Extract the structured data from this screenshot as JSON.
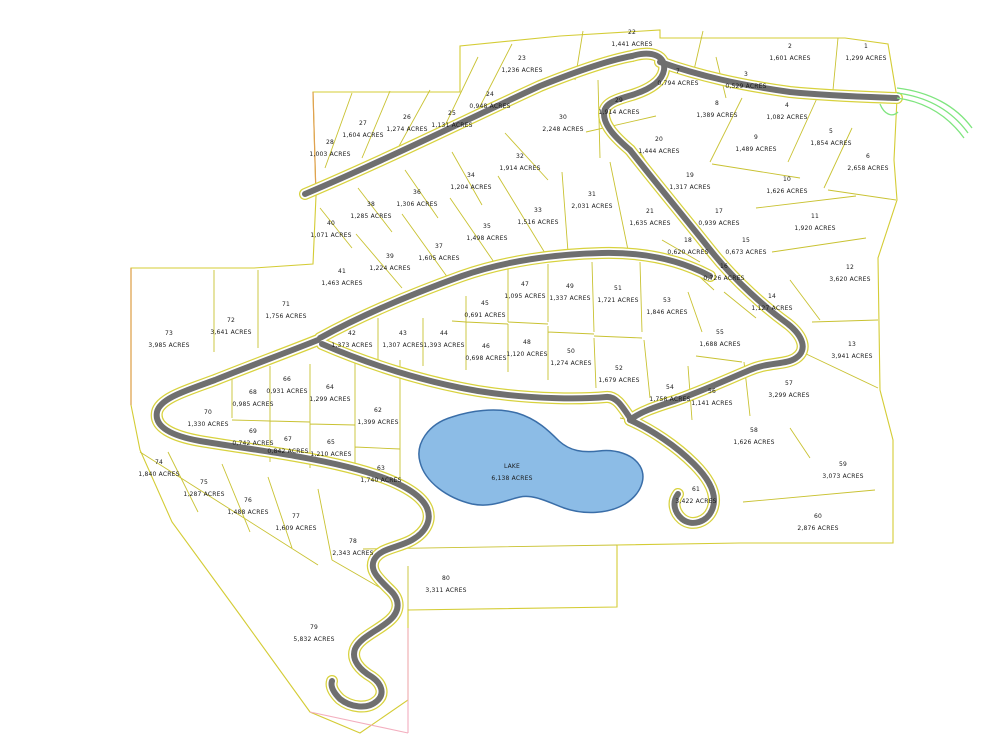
{
  "map": {
    "type": "subdivision-plat-map",
    "units_suffix": "ACRES",
    "colors": {
      "lot_line": "#c9c232",
      "boundary": "#d4cc35",
      "road_core": "#6f6f6f",
      "road_edge": "#d8d23e",
      "lake_fill": "#8cbce6",
      "lake_outline": "#3a6ea8",
      "creek": "#7fe57f",
      "west_boundary_orange": "#e0a050",
      "south_boundary_pink": "#f3aebe",
      "text": "#1a1a1a"
    }
  },
  "lake": {
    "label": "LAKE",
    "acres": "6,138 ACRES",
    "x": 512,
    "y": 472
  },
  "lots": [
    {
      "n": "1",
      "a": "1,299 ACRES",
      "x": 866,
      "y": 52
    },
    {
      "n": "2",
      "a": "1,601 ACRES",
      "x": 790,
      "y": 52
    },
    {
      "n": "3",
      "a": "0,529 ACRES",
      "x": 746,
      "y": 80
    },
    {
      "n": "4",
      "a": "1,082 ACRES",
      "x": 787,
      "y": 111
    },
    {
      "n": "5",
      "a": "1,854 ACRES",
      "x": 831,
      "y": 137
    },
    {
      "n": "6",
      "a": "2,658 ACRES",
      "x": 868,
      "y": 162
    },
    {
      "n": "7",
      "a": "0,794 ACRES",
      "x": 678,
      "y": 77
    },
    {
      "n": "8",
      "a": "1,389 ACRES",
      "x": 717,
      "y": 109
    },
    {
      "n": "9",
      "a": "1,489 ACRES",
      "x": 756,
      "y": 143
    },
    {
      "n": "10",
      "a": "1,626 ACRES",
      "x": 787,
      "y": 185
    },
    {
      "n": "11",
      "a": "1,920 ACRES",
      "x": 815,
      "y": 222
    },
    {
      "n": "12",
      "a": "3,620 ACRES",
      "x": 850,
      "y": 273
    },
    {
      "n": "13",
      "a": "3,941 ACRES",
      "x": 852,
      "y": 350
    },
    {
      "n": "14",
      "a": "1,127 ACRES",
      "x": 772,
      "y": 302
    },
    {
      "n": "15",
      "a": "0,673 ACRES",
      "x": 746,
      "y": 246
    },
    {
      "n": "16",
      "a": "0,726 ACRES",
      "x": 724,
      "y": 272
    },
    {
      "n": "17",
      "a": "0,939 ACRES",
      "x": 719,
      "y": 217
    },
    {
      "n": "18",
      "a": "0,620 ACRES",
      "x": 688,
      "y": 246
    },
    {
      "n": "19",
      "a": "1,317 ACRES",
      "x": 690,
      "y": 181
    },
    {
      "n": "20",
      "a": "1,444 ACRES",
      "x": 659,
      "y": 145
    },
    {
      "n": "21",
      "a": "1,635 ACRES",
      "x": 650,
      "y": 217
    },
    {
      "n": "22",
      "a": "1,441 ACRES",
      "x": 632,
      "y": 38
    },
    {
      "n": "23",
      "a": "1,236 ACRES",
      "x": 522,
      "y": 64
    },
    {
      "n": "24",
      "a": "0,948 ACRES",
      "x": 490,
      "y": 100
    },
    {
      "n": "25",
      "a": "1,131 ACRES",
      "x": 452,
      "y": 119
    },
    {
      "n": "26",
      "a": "1,274 ACRES",
      "x": 407,
      "y": 123
    },
    {
      "n": "27",
      "a": "1,604 ACRES",
      "x": 363,
      "y": 129
    },
    {
      "n": "28",
      "a": "1,003 ACRES",
      "x": 330,
      "y": 148
    },
    {
      "n": "29",
      "a": "1,914 ACRES",
      "x": 619,
      "y": 106
    },
    {
      "n": "30",
      "a": "2,248 ACRES",
      "x": 563,
      "y": 123
    },
    {
      "n": "31",
      "a": "2,031 ACRES",
      "x": 592,
      "y": 200
    },
    {
      "n": "32",
      "a": "1,914 ACRES",
      "x": 520,
      "y": 162
    },
    {
      "n": "33",
      "a": "1,516 ACRES",
      "x": 538,
      "y": 216
    },
    {
      "n": "34",
      "a": "1,204 ACRES",
      "x": 471,
      "y": 181
    },
    {
      "n": "35",
      "a": "1,498 ACRES",
      "x": 487,
      "y": 232
    },
    {
      "n": "36",
      "a": "1,306 ACRES",
      "x": 417,
      "y": 198
    },
    {
      "n": "37",
      "a": "1,605 ACRES",
      "x": 439,
      "y": 252
    },
    {
      "n": "38",
      "a": "1,285 ACRES",
      "x": 371,
      "y": 210
    },
    {
      "n": "39",
      "a": "1,224 ACRES",
      "x": 390,
      "y": 262
    },
    {
      "n": "40",
      "a": "1,071 ACRES",
      "x": 331,
      "y": 229
    },
    {
      "n": "41",
      "a": "1,463 ACRES",
      "x": 342,
      "y": 277
    },
    {
      "n": "42",
      "a": "1,373 ACRES",
      "x": 352,
      "y": 339
    },
    {
      "n": "43",
      "a": "1,307 ACRES",
      "x": 403,
      "y": 339
    },
    {
      "n": "44",
      "a": "1,393 ACRES",
      "x": 444,
      "y": 339
    },
    {
      "n": "45",
      "a": "0,691 ACRES",
      "x": 485,
      "y": 309
    },
    {
      "n": "46",
      "a": "0,698 ACRES",
      "x": 486,
      "y": 352
    },
    {
      "n": "47",
      "a": "1,095 ACRES",
      "x": 525,
      "y": 290
    },
    {
      "n": "48",
      "a": "1,120 ACRES",
      "x": 527,
      "y": 348
    },
    {
      "n": "49",
      "a": "1,337 ACRES",
      "x": 570,
      "y": 292
    },
    {
      "n": "50",
      "a": "1,274 ACRES",
      "x": 571,
      "y": 357
    },
    {
      "n": "51",
      "a": "1,721 ACRES",
      "x": 618,
      "y": 294
    },
    {
      "n": "52",
      "a": "1,679 ACRES",
      "x": 619,
      "y": 374
    },
    {
      "n": "53",
      "a": "1,846 ACRES",
      "x": 667,
      "y": 306
    },
    {
      "n": "54",
      "a": "1,758 ACRES",
      "x": 670,
      "y": 393
    },
    {
      "n": "55",
      "a": "1,688 ACRES",
      "x": 720,
      "y": 338
    },
    {
      "n": "56",
      "a": "1,141 ACRES",
      "x": 712,
      "y": 397
    },
    {
      "n": "57",
      "a": "3,299 ACRES",
      "x": 789,
      "y": 389
    },
    {
      "n": "58",
      "a": "1,626 ACRES",
      "x": 754,
      "y": 436
    },
    {
      "n": "59",
      "a": "3,073 ACRES",
      "x": 843,
      "y": 470
    },
    {
      "n": "60",
      "a": "2,876 ACRES",
      "x": 818,
      "y": 522
    },
    {
      "n": "61",
      "a": "3,422 ACRES",
      "x": 696,
      "y": 495
    },
    {
      "n": "62",
      "a": "1,399 ACRES",
      "x": 378,
      "y": 416
    },
    {
      "n": "63",
      "a": "1,740 ACRES",
      "x": 381,
      "y": 474
    },
    {
      "n": "64",
      "a": "1,299 ACRES",
      "x": 330,
      "y": 393
    },
    {
      "n": "65",
      "a": "1,210 ACRES",
      "x": 331,
      "y": 448
    },
    {
      "n": "66",
      "a": "0,931 ACRES",
      "x": 287,
      "y": 385
    },
    {
      "n": "67",
      "a": "0,842 ACRES",
      "x": 288,
      "y": 445
    },
    {
      "n": "68",
      "a": "0,985 ACRES",
      "x": 253,
      "y": 398
    },
    {
      "n": "69",
      "a": "0,742 ACRES",
      "x": 253,
      "y": 437
    },
    {
      "n": "70",
      "a": "1,330 ACRES",
      "x": 208,
      "y": 418
    },
    {
      "n": "71",
      "a": "1,756 ACRES",
      "x": 286,
      "y": 310
    },
    {
      "n": "72",
      "a": "3,641 ACRES",
      "x": 231,
      "y": 326
    },
    {
      "n": "73",
      "a": "3,985 ACRES",
      "x": 169,
      "y": 339
    },
    {
      "n": "74",
      "a": "1,840 ACRES",
      "x": 159,
      "y": 468
    },
    {
      "n": "75",
      "a": "1,287 ACRES",
      "x": 204,
      "y": 488
    },
    {
      "n": "76",
      "a": "1,488 ACRES",
      "x": 248,
      "y": 506
    },
    {
      "n": "77",
      "a": "1,609 ACRES",
      "x": 296,
      "y": 522
    },
    {
      "n": "78",
      "a": "2,343 ACRES",
      "x": 353,
      "y": 547
    },
    {
      "n": "79",
      "a": "5,832 ACRES",
      "x": 314,
      "y": 633
    },
    {
      "n": "80",
      "a": "3,311 ACRES",
      "x": 446,
      "y": 584
    }
  ]
}
